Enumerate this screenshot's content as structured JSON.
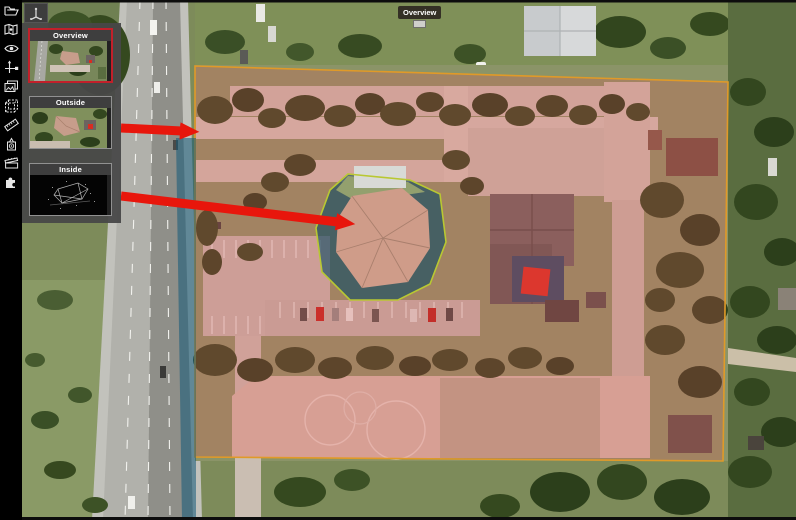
{
  "window": {
    "width": 796,
    "height": 520,
    "kind": "3d-scan-aerial-viewer"
  },
  "toolbar": {
    "icons": [
      {
        "name": "open-folder-icon",
        "title": "Open"
      },
      {
        "name": "map-icon",
        "title": "Map"
      },
      {
        "name": "eye-icon",
        "title": "View"
      },
      {
        "name": "move-axes-icon",
        "title": "Move"
      },
      {
        "name": "images-icon",
        "title": "Images"
      },
      {
        "name": "cube-icon",
        "title": "Bounding box"
      },
      {
        "name": "measure-icon",
        "title": "Measure"
      },
      {
        "name": "instrument-icon",
        "title": "Scan stations"
      },
      {
        "name": "clapperboard-icon",
        "title": "Media"
      },
      {
        "name": "puzzle-icon",
        "title": "Plugins"
      }
    ]
  },
  "viewpoint_panel": {
    "items": [
      {
        "label": "Overview",
        "selected": true,
        "kind": "aerial"
      },
      {
        "label": "Outside",
        "selected": false,
        "kind": "aerial"
      },
      {
        "label": "Inside",
        "selected": false,
        "kind": "pointcloud"
      }
    ]
  },
  "map": {
    "marker_label": "Overview",
    "colors": {
      "property_overlay_fill": "#e05454",
      "property_overlay_border": "#e09a28",
      "building_outline": "#b9c832",
      "scan_band_teal": "#135a78",
      "arrow_red": "#e8160c",
      "selected_thumb_border": "#c2202a"
    }
  }
}
